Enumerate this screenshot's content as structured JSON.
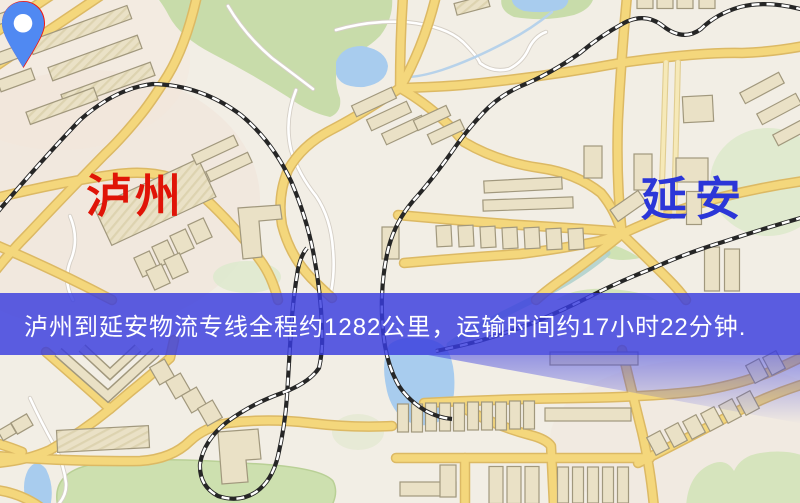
{
  "map": {
    "kind": "road-map-screenshot",
    "origin": {
      "name": "泸州",
      "label_color": "#e01407",
      "pin_color": "#f3150b",
      "pin_inner_color": "#ffffff"
    },
    "destination": {
      "name": "延安",
      "label_color": "#2b36d8",
      "pin_color": "#5089f2",
      "pin_inner_color": "#ffffff"
    },
    "banner": {
      "text": "泸州到延安物流专线全程约1282公里，运输时间约17小时22分钟.",
      "distance_text": "约1282公里",
      "duration_text": "约17小时22分钟",
      "background": "#383cde",
      "text_color": "#ffffff"
    },
    "palette": {
      "map_background": "#f2eee5",
      "road_fill": "#f4d77c",
      "road_casing": "#dcb964",
      "park_green": "#cde0af",
      "water_blue": "#a8ccee",
      "building_fill": "#eae1c6",
      "railway": "#262626"
    }
  }
}
